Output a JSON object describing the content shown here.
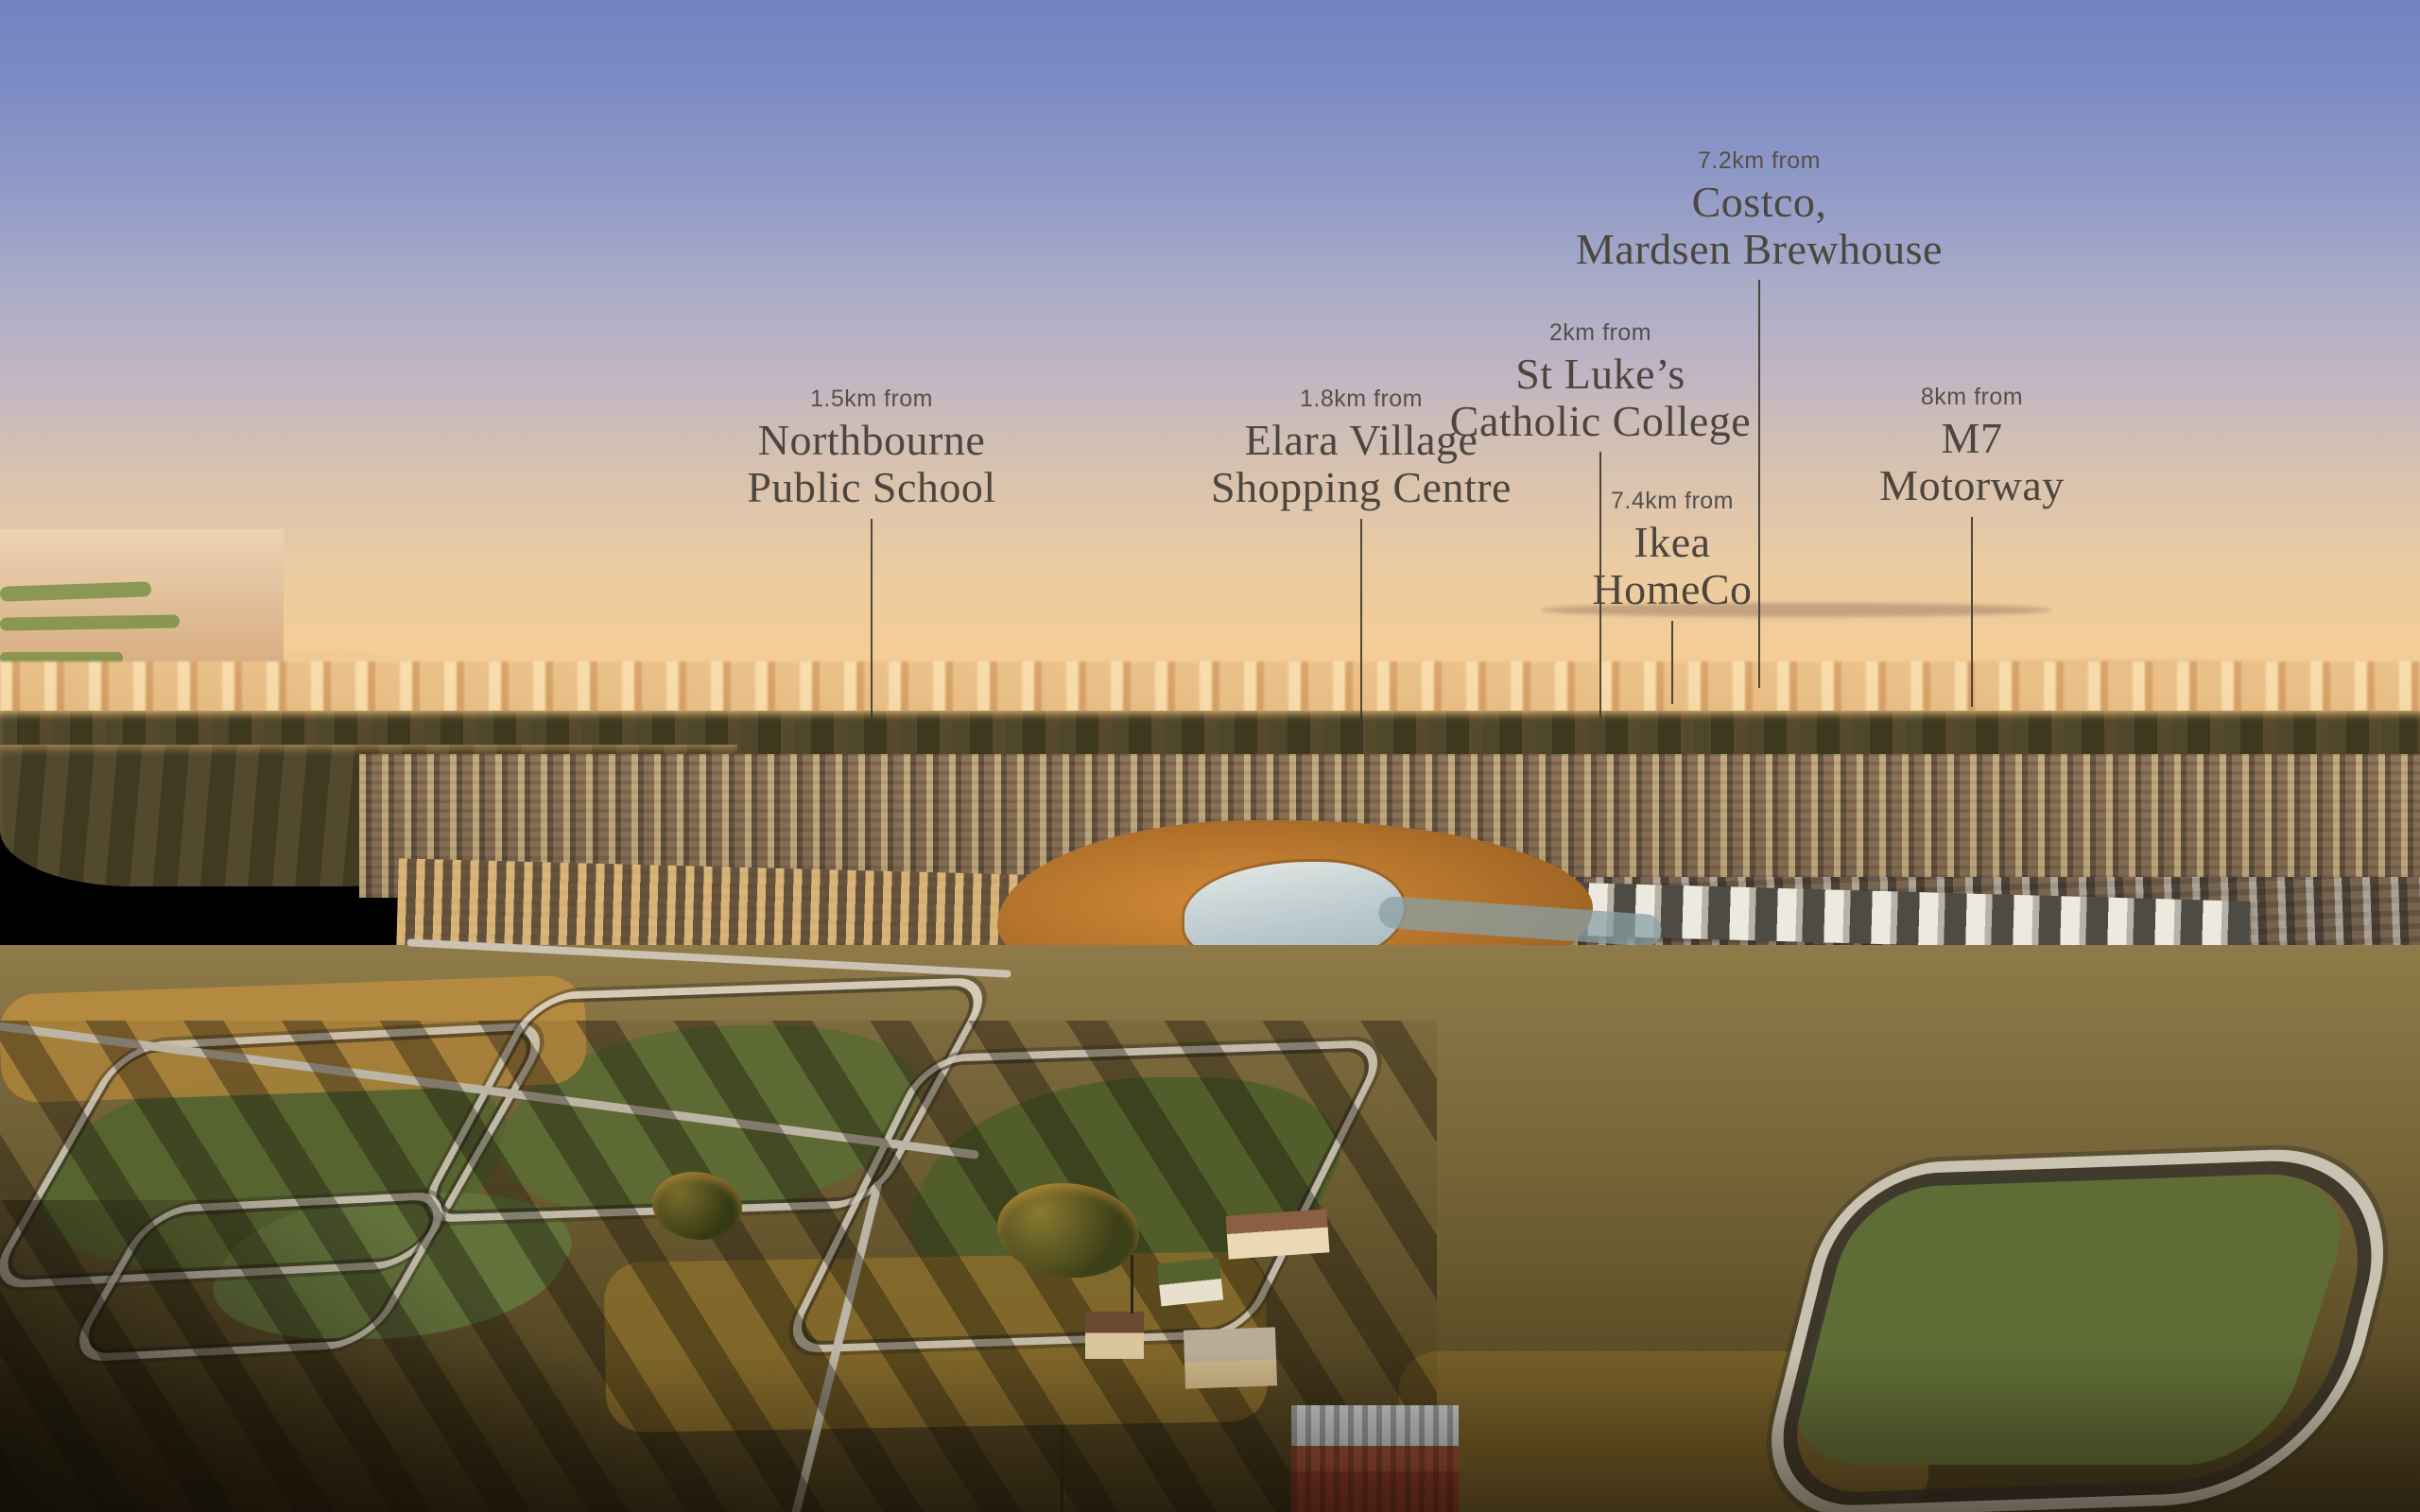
{
  "colors": {
    "label_text": "#4c463e",
    "distance_text": "#56504a",
    "leader_line": "#3e382f",
    "sky_top": "#7083c1",
    "sky_horizon_peach": "#f4cd96",
    "sunset_orange": "#f0c187"
  },
  "callouts": [
    {
      "id": "northbourne-public-school",
      "distance": "1.5km from",
      "line1": "Northbourne",
      "line2": "Public School"
    },
    {
      "id": "elara-village-shopping-centre",
      "distance": "1.8km from",
      "line1": "Elara Village",
      "line2": "Shopping Centre"
    },
    {
      "id": "st-lukes-catholic-college",
      "distance": "2km from",
      "line1": "St Luke’s",
      "line2": "Catholic College"
    },
    {
      "id": "costco-mardsen-brewhouse",
      "distance": "7.2km from",
      "line1": "Costco,",
      "line2": "Mardsen Brewhouse"
    },
    {
      "id": "ikea-homeco",
      "distance": "7.4km from",
      "line1": "Ikea",
      "line2": "HomeCo"
    },
    {
      "id": "m7-motorway",
      "distance": "8km from",
      "line1": "M7",
      "line2": "Motorway"
    }
  ]
}
